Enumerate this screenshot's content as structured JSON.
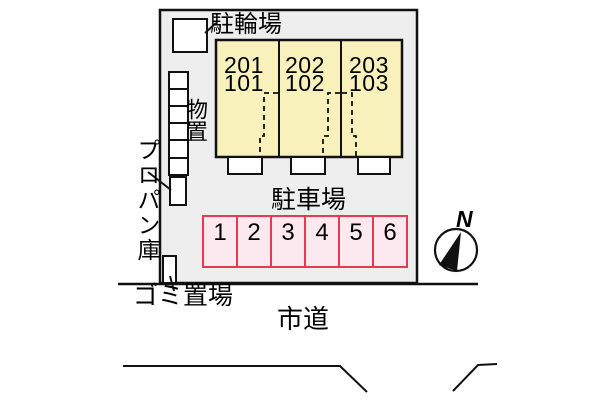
{
  "plan": {
    "title_labels": {
      "bicycle_parking": "駐輪場",
      "storage": "物置",
      "propane": "プロパン庫",
      "garbage": "ゴミ置場",
      "parking_lot": "駐車場",
      "city_road": "市道",
      "north": "N"
    },
    "building": {
      "units": [
        {
          "upper": "201",
          "lower": "101"
        },
        {
          "upper": "202",
          "lower": "102"
        },
        {
          "upper": "203",
          "lower": "103"
        }
      ]
    },
    "parking_spaces": [
      "1",
      "2",
      "3",
      "4",
      "5",
      "6"
    ],
    "colors": {
      "site_fill": "#eeeeee",
      "building_fill": "#f8f1bc",
      "parking_fill": "#fbe9ef",
      "parking_border": "#e8394f",
      "line": "#111111",
      "background": "#ffffff"
    }
  }
}
